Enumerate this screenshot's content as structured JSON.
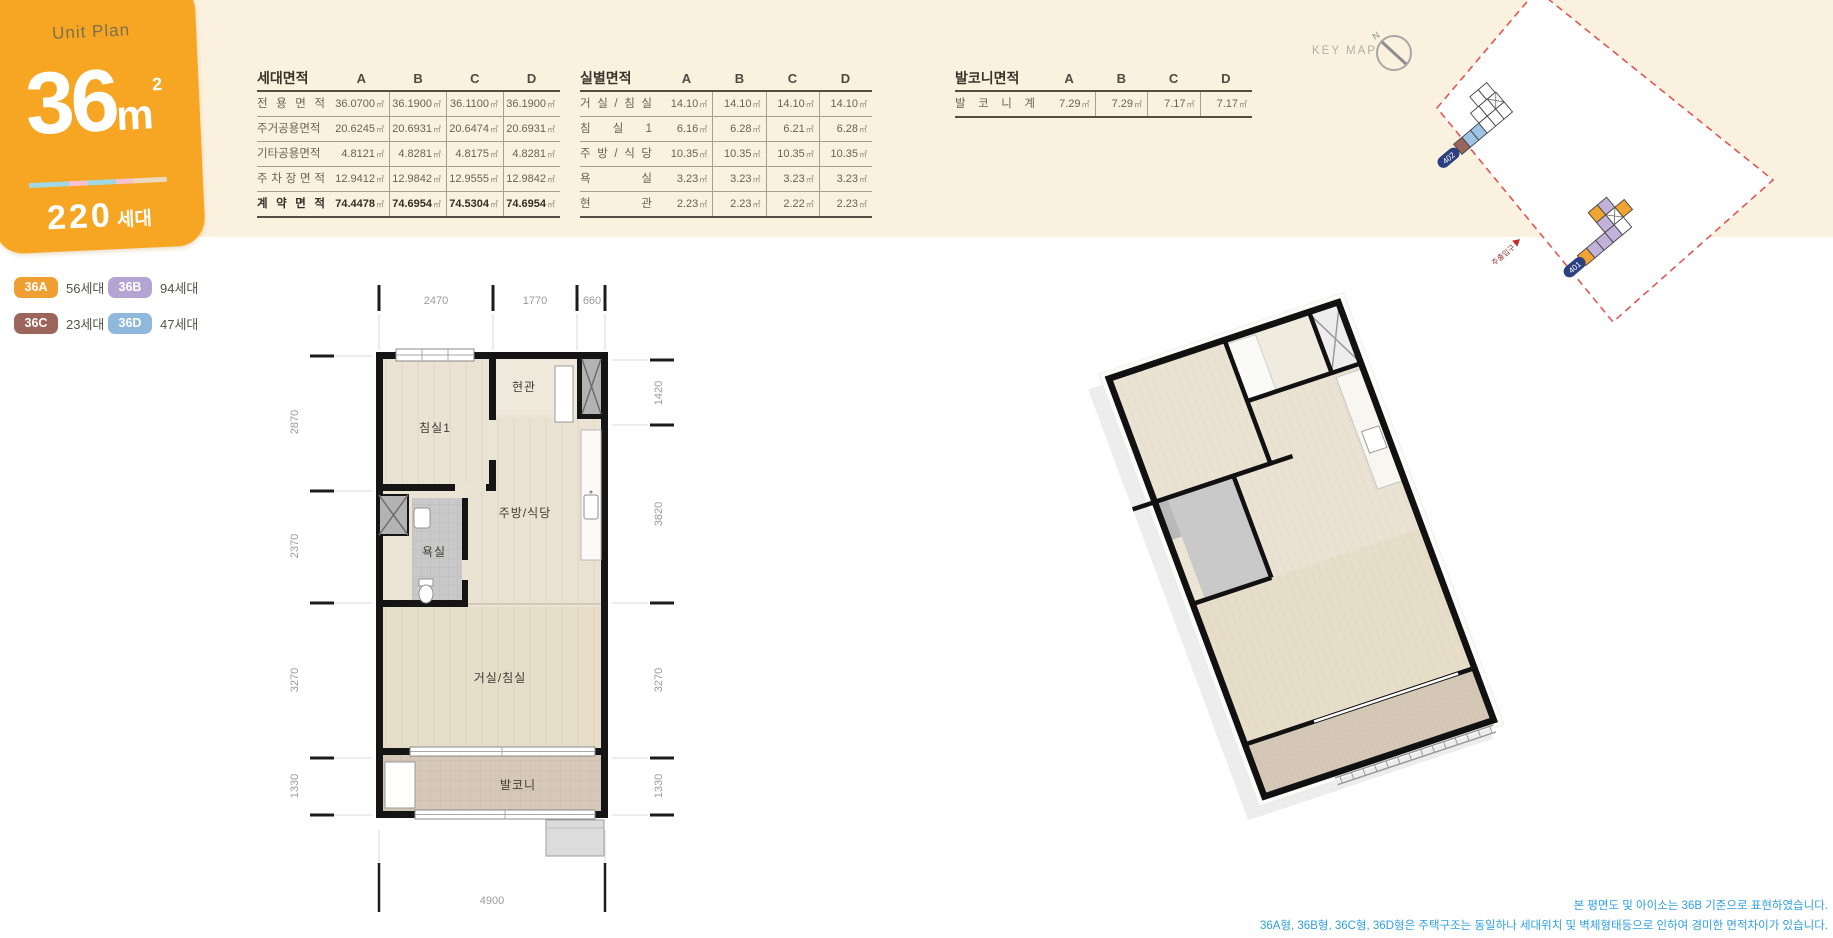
{
  "badge": {
    "title": "Unit Plan",
    "area": "36",
    "area_unit": "m",
    "area_exp": "2",
    "households": "220",
    "households_unit": "세대",
    "stripe": [
      "#9fd9e8",
      "#f4c3d2",
      "#9fd9e8",
      "#f4c3d2",
      "#ecd9bd"
    ]
  },
  "legend": {
    "items": [
      {
        "code": "36A",
        "count": "56세대",
        "color": "#f0a032"
      },
      {
        "code": "36B",
        "count": "94세대",
        "color": "#b3a4d4"
      },
      {
        "code": "36C",
        "count": "23세대",
        "color": "#9b655c"
      },
      {
        "code": "36D",
        "count": "47세대",
        "color": "#8fb8dc"
      }
    ]
  },
  "tables": {
    "unit_area": {
      "title": "세대면적",
      "unit": "㎡",
      "columns": [
        "A",
        "B",
        "C",
        "D"
      ],
      "rows": [
        {
          "label": "전 용 면 적",
          "values": [
            "36.0700",
            "36.1900",
            "36.1100",
            "36.1900"
          ]
        },
        {
          "label": "주거공용면적",
          "values": [
            "20.6245",
            "20.6931",
            "20.6474",
            "20.6931"
          ]
        },
        {
          "label": "기타공용면적",
          "values": [
            "4.8121",
            "4.8281",
            "4.8175",
            "4.8281"
          ]
        },
        {
          "label": "주 차 장 면 적",
          "values": [
            "12.9412",
            "12.9842",
            "12.9555",
            "12.9842"
          ]
        },
        {
          "label": "계 약 면 적",
          "values": [
            "74.4478",
            "74.6954",
            "74.5304",
            "74.6954"
          ],
          "bold": true
        }
      ]
    },
    "room_area": {
      "title": "실별면적",
      "unit": "㎡",
      "columns": [
        "A",
        "B",
        "C",
        "D"
      ],
      "rows": [
        {
          "label": "거 실 / 침 실",
          "values": [
            "14.10",
            "14.10",
            "14.10",
            "14.10"
          ]
        },
        {
          "label": "침 실 1",
          "values": [
            "6.16",
            "6.28",
            "6.21",
            "6.28"
          ]
        },
        {
          "label": "주 방 / 식 당",
          "values": [
            "10.35",
            "10.35",
            "10.35",
            "10.35"
          ]
        },
        {
          "label": "욕 실",
          "values": [
            "3.23",
            "3.23",
            "3.23",
            "3.23"
          ]
        },
        {
          "label": "현 관",
          "values": [
            "2.23",
            "2.23",
            "2.22",
            "2.23"
          ]
        }
      ]
    },
    "balcony_area": {
      "title": "발코니면적",
      "unit": "㎡",
      "columns": [
        "A",
        "B",
        "C",
        "D"
      ],
      "rows": [
        {
          "label": "발 코 니 계",
          "values": [
            "7.29",
            "7.29",
            "7.17",
            "7.17"
          ]
        }
      ]
    }
  },
  "keymap": {
    "label": "KEY MAP",
    "north": "N",
    "building_402": "402",
    "building_401": "401",
    "entrance": "주출입구"
  },
  "floorplan": {
    "rooms": {
      "bedroom1": "침실1",
      "entry": "현관",
      "bath": "욕실",
      "kitchen": "주방/식당",
      "living": "거실/침실",
      "balcony": "발코니"
    },
    "dims": {
      "top": [
        "2470",
        "1770",
        "660"
      ],
      "left": [
        "2870",
        "2370",
        "3270",
        "1330"
      ],
      "right": [
        "1420",
        "3820",
        "3270",
        "1330"
      ],
      "bottom": [
        "4900"
      ]
    }
  },
  "footnote": {
    "line1": "본 평면도 및 아이소는 36B 기준으로 표현하였습니다.",
    "line2": "36A형, 36B형, 36C형, 36D형은 주택구조는 동일하나 세대위치 및 벽체형태등으로 인하여 경미한 면적차이가 있습니다."
  },
  "colors": {
    "accent_orange": "#f6a623",
    "band_cream": "#faf1de",
    "footnote_blue": "#2f9fe0"
  }
}
